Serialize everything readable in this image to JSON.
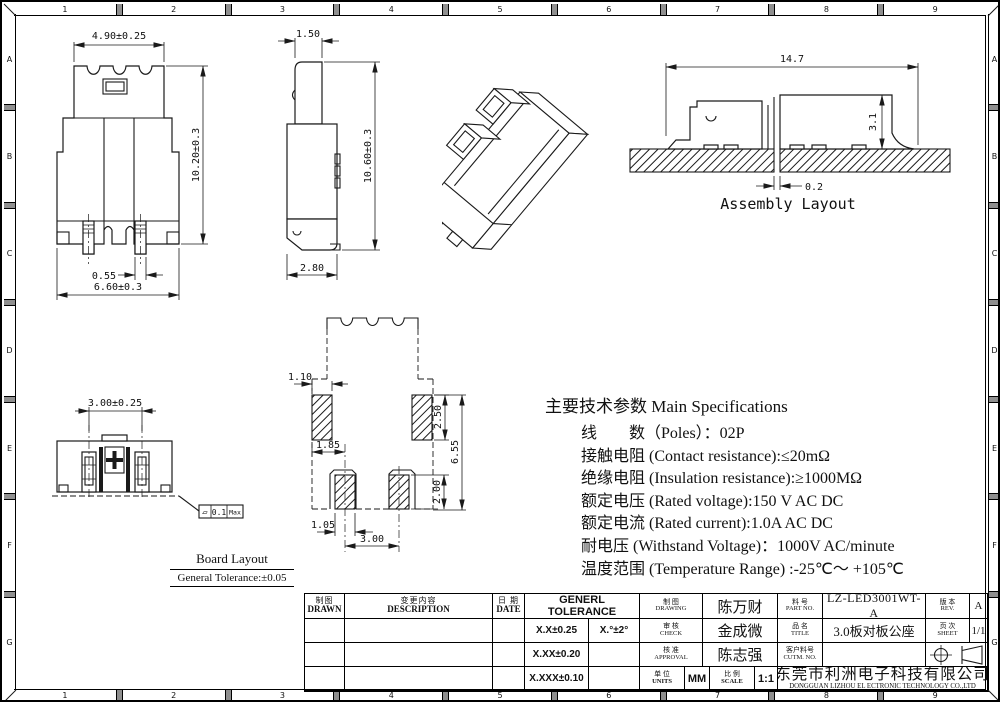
{
  "border": {
    "h_labels": [
      "1",
      "2",
      "3",
      "4",
      "5",
      "6",
      "7",
      "8",
      "9"
    ],
    "v_labels": [
      "A",
      "B",
      "C",
      "D",
      "E",
      "F",
      "G"
    ]
  },
  "front_view": {
    "width": "4.90±0.25",
    "height": "10.20±0.3",
    "pin_width": "0.55",
    "base_width": "6.60±0.3"
  },
  "side_view": {
    "width": "1.50",
    "height": "10.60±0.3",
    "base_width": "2.80"
  },
  "assembly": {
    "width": "14.7",
    "height": "3.1",
    "gap": "0.2",
    "caption": "Assembly Layout"
  },
  "pad_layout": {
    "pad_width_top": "1.10",
    "pad_height_top": "2.50",
    "overall_height": "6.55",
    "offset": "1.85",
    "pad_height_bottom": "2.00",
    "pad_width_bottom": "1.05",
    "pitch": "3.00"
  },
  "board_layout": {
    "pitch": "3.00±0.25",
    "flatness_symbol": "▱",
    "flatness_value": "0.1",
    "flatness_suffix": "Max",
    "caption": "Board Layout",
    "tolerance_note": "General Tolerance:±0.05"
  },
  "specs": {
    "title": "主要技术参数 Main Specifications",
    "lines": [
      "线　　数（Poles）：02P",
      "接触电阻 (Contact resistance):≤20mΩ",
      "绝缘电阻 (Insulation resistance):≥1000MΩ",
      "额定电压 (Rated voltage):150 V AC DC",
      "额定电流 (Rated current):1.0A AC DC",
      "耐电压 (Withstand Voltage)：1000V AC/minute",
      "温度范围 (Temperature Range) :-25℃～ +105℃"
    ]
  },
  "title_block": {
    "revision": {
      "drawn_cn": "制图",
      "drawn_en": "DRAWN",
      "description_cn": "变更内容",
      "description_en": "DESCRIPTION",
      "date_cn": "日 期",
      "date_en": "DATE"
    },
    "tolerance": {
      "title": "GENERL TOLERANCE",
      "rows": [
        {
          "a": "X.X±0.25",
          "b": "X.°±2°"
        },
        {
          "a": "X.XX±0.20",
          "b": ""
        },
        {
          "a": "X.XXX±0.10",
          "b": ""
        }
      ]
    },
    "signatures": {
      "drawing_cn": "制 图",
      "drawing_en": "DRAWING",
      "drawing_name": "陈万财",
      "check_cn": "审 核",
      "check_en": "CHECK",
      "check_name": "金成微",
      "approval_cn": "核 准",
      "approval_en": "APPROVAL",
      "approval_name": "陈志强"
    },
    "units": {
      "cn": "单 位",
      "en": "UNITS",
      "value": "MM"
    },
    "scale": {
      "cn": "比 例",
      "en": "SCALE",
      "value": "1:1"
    },
    "part": {
      "no_cn": "料 号",
      "no_en": "PART NO.",
      "no_value": "LZ-LED3001WT-A",
      "title_cn": "品 名",
      "title_en": "TITLE",
      "title_value": "3.0板对板公座",
      "cust_cn": "客户料号",
      "cust_en": "CUTM. NO.",
      "cust_value": ""
    },
    "rev": {
      "cn": "版 本",
      "en": "REV.",
      "value": "A",
      "sheet_cn": "页 次",
      "sheet_en": "SHEET",
      "sheet_value": "1/1"
    },
    "company": {
      "cn": "东莞市利洲电子科技有限公司",
      "en": "DONGGUAN LIZHOU EL ECTRONIC TECHNOLOGY CO.,LTD"
    }
  }
}
